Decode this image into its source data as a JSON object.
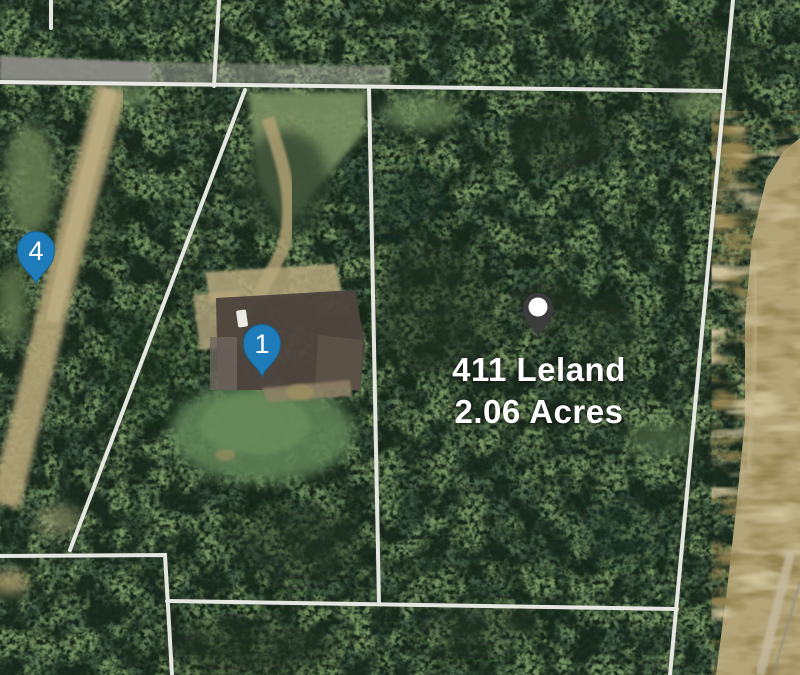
{
  "map_overlay": {
    "property_label": {
      "line1": "411 Leland",
      "line2": "2.06 Acres",
      "text_color": "#ffffff"
    },
    "markers": {
      "marker_4": {
        "label": "4",
        "color": "#1e7cba"
      },
      "marker_1": {
        "label": "1",
        "color": "#1e7cba"
      },
      "property_pin": {
        "color": "#3c3c3c",
        "dot_color": "#ffffff"
      }
    },
    "parcel_line_color": "#eceee8",
    "terrain_colors": {
      "forest": "#46604a",
      "field": "#b3a478",
      "road": "#8b8b86",
      "dirt_road": "#b3a377",
      "lawn": "#5f8054",
      "roof": "#4e453d"
    }
  }
}
